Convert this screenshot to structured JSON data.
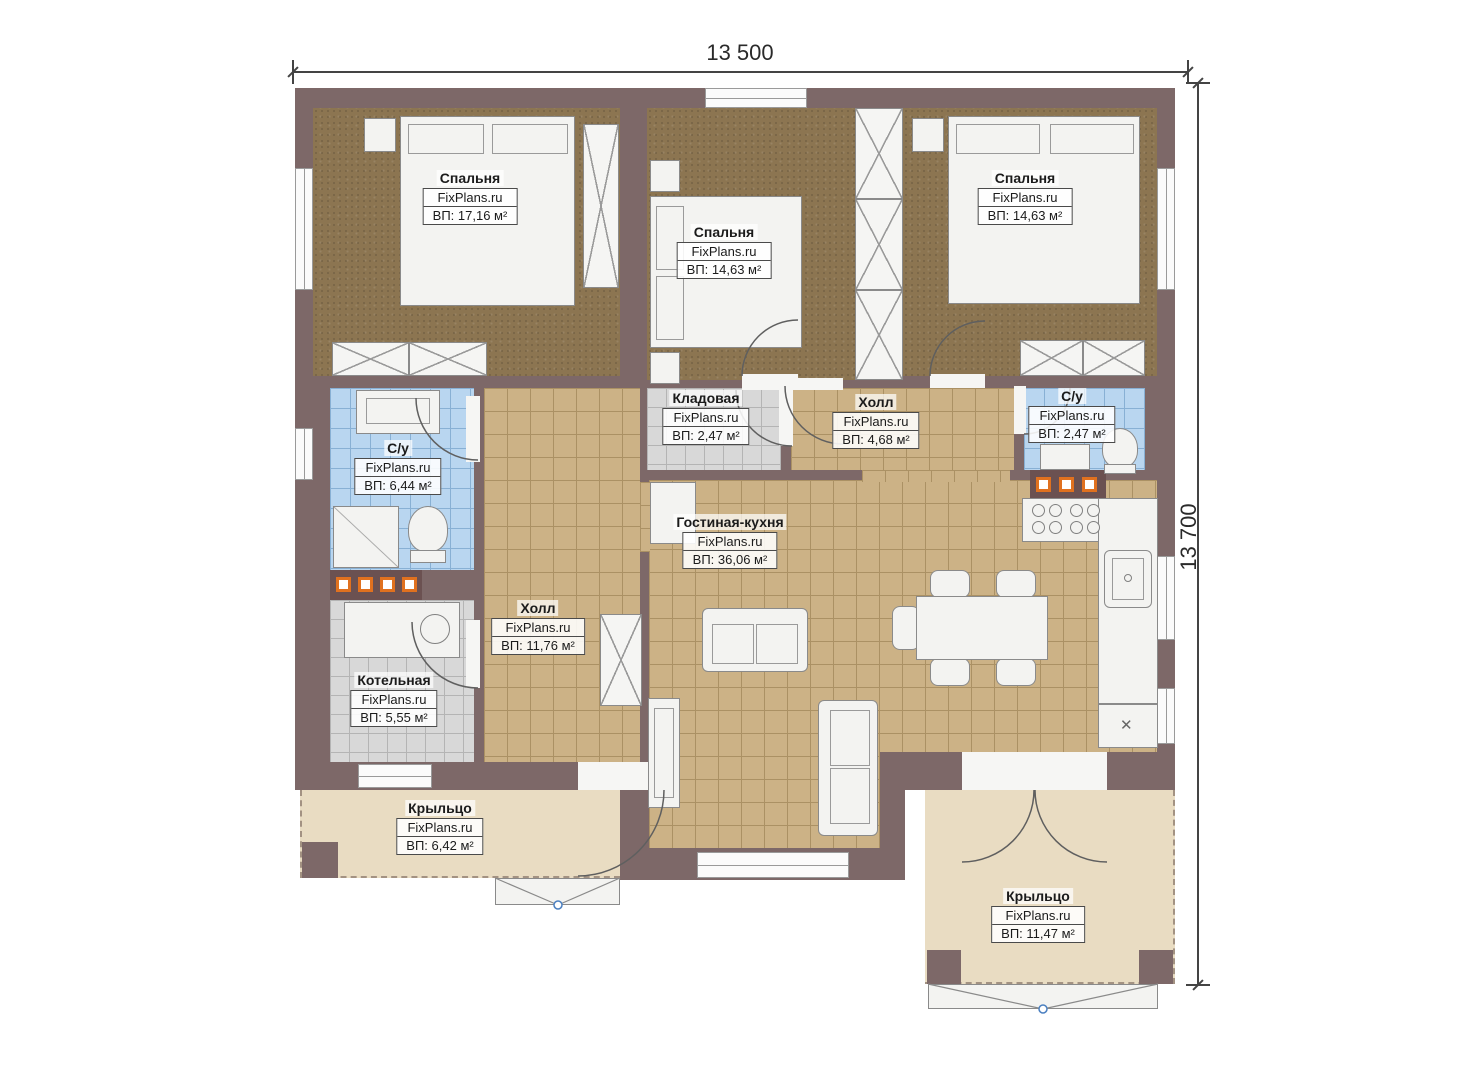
{
  "dimensions": {
    "width_label": "13 500",
    "height_label": "13 700"
  },
  "rooms": [
    {
      "id": "bedroom-1",
      "name": "Спальня",
      "brand": "FixPlans.ru",
      "area": "ВП: 17,16 м²"
    },
    {
      "id": "bedroom-2",
      "name": "Спальня",
      "brand": "FixPlans.ru",
      "area": "ВП: 14,63 м²"
    },
    {
      "id": "bedroom-3",
      "name": "Спальня",
      "brand": "FixPlans.ru",
      "area": "ВП: 14,63 м²"
    },
    {
      "id": "storage",
      "name": "Кладовая",
      "brand": "FixPlans.ru",
      "area": "ВП: 2,47 м²"
    },
    {
      "id": "hall-small",
      "name": "Холл",
      "brand": "FixPlans.ru",
      "area": "ВП: 4,68 м²"
    },
    {
      "id": "bathroom-right",
      "name": "С/у",
      "brand": "FixPlans.ru",
      "area": "ВП: 2,47 м²"
    },
    {
      "id": "bathroom-left",
      "name": "С/у",
      "brand": "FixPlans.ru",
      "area": "ВП: 6,44 м²"
    },
    {
      "id": "hall-main",
      "name": "Холл",
      "brand": "FixPlans.ru",
      "area": "ВП: 11,76 м²"
    },
    {
      "id": "living-kitchen",
      "name": "Гостиная-кухня",
      "brand": "FixPlans.ru",
      "area": "ВП: 36,06 м²"
    },
    {
      "id": "boiler",
      "name": "Котельная",
      "brand": "FixPlans.ru",
      "area": "ВП: 5,55 м²"
    },
    {
      "id": "porch-left",
      "name": "Крыльцо",
      "brand": "FixPlans.ru",
      "area": "ВП: 6,42 м²"
    },
    {
      "id": "porch-right",
      "name": "Крыльцо",
      "brand": "FixPlans.ru",
      "area": "ВП: 11,47 м²"
    }
  ],
  "colors": {
    "wall": "#7d6868",
    "wall_dark": "#6b5151",
    "bedroom_floor": "#8c7551",
    "tile_tan": "#ccb286",
    "tile_blue": "#b9d6f0",
    "tile_gray": "#d8d8d8",
    "porch": "#e9dcc2",
    "accent_orange": "#e0711f"
  },
  "misc": {
    "kitchen_mark": "✕"
  }
}
